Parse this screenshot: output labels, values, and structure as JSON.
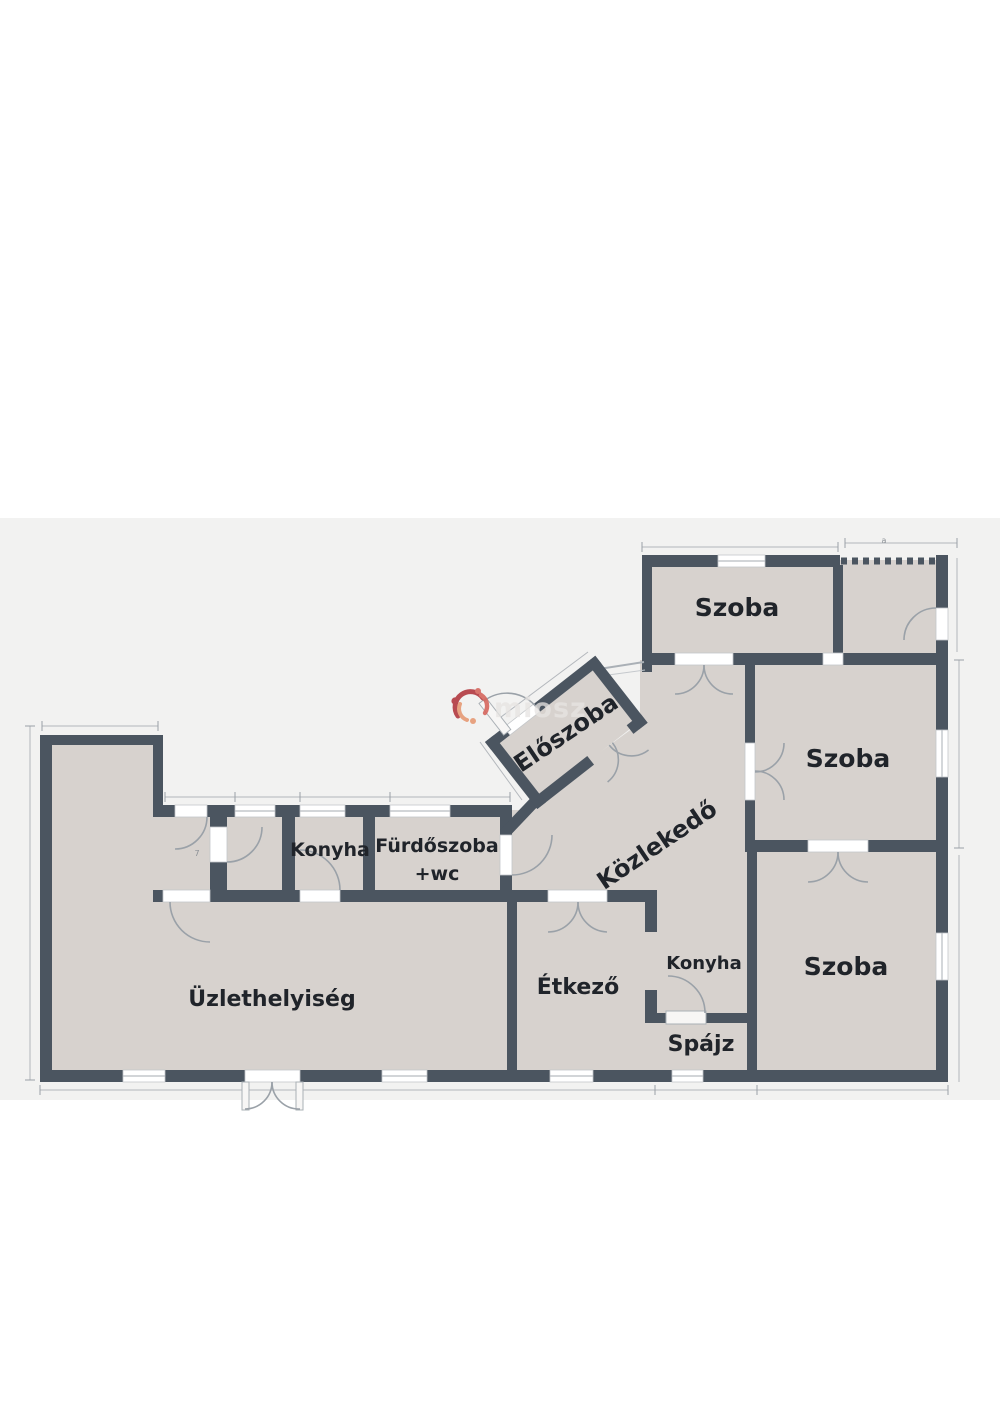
{
  "watermark": {
    "text": "miosz"
  },
  "rooms": {
    "szoba_top": "Szoba",
    "szoba_right": "Szoba",
    "szoba_bottom": "Szoba",
    "eloszoba": "Előszoba",
    "kozlekedo": "Közlekedő",
    "konyha_left": "Konyha",
    "furdoszoba_l1": "Fürdőszoba",
    "furdoszoba_l2": "+wc",
    "uzlethelyiseg": "Üzlethelyiség",
    "etkezo": "Étkező",
    "konyha_right": "Konyha",
    "spajz": "Spájz"
  },
  "dim_marks": {
    "entry_mark": "7",
    "terrace_mark": "a"
  },
  "colors": {
    "wall": "#4b5560",
    "floor": "#d7d2ce",
    "panel": "#f2f2f1",
    "background": "#ffffff",
    "watermark_red": "#b23a40",
    "label_text": "#20242a"
  }
}
